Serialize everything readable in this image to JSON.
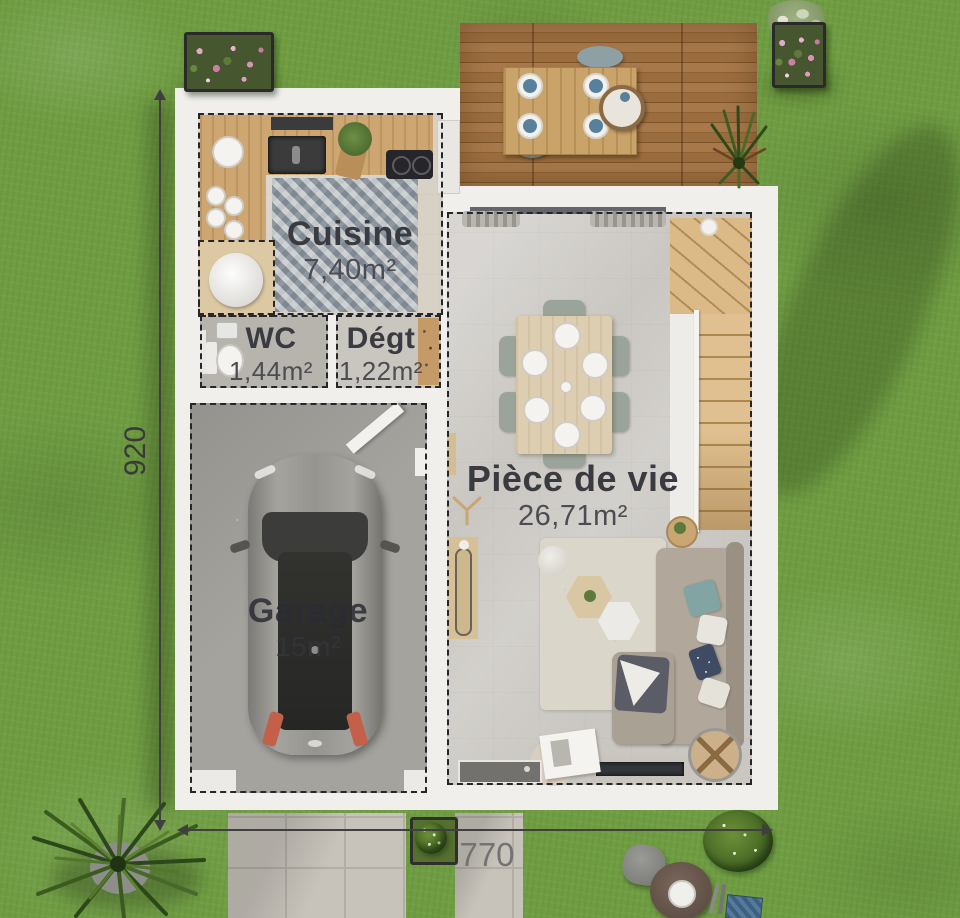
{
  "plan": {
    "title_note": "floor plan top view",
    "rooms": {
      "cuisine": {
        "name": "Cuisine",
        "area": "7,40m²"
      },
      "wc": {
        "name": "WC",
        "area": "1,44m²"
      },
      "degt": {
        "name": "Dégt",
        "area": "1,22m²"
      },
      "piece_de_vie": {
        "name": "Pièce de vie",
        "area": "26,71m²"
      },
      "garage": {
        "name": "Garage",
        "area": "15m²"
      }
    },
    "dimensions": {
      "height_label": "920",
      "width_label": "770"
    },
    "colors": {
      "grass": "#6f9d42",
      "deck_wood": "#9b6d3e",
      "wall_white": "#f0efec",
      "living_floor": "#cac7c2",
      "garage_floor": "#a5a39e",
      "label_text": "#3a3a41",
      "dimension_text": "#6f6f6f",
      "dashed_border": "#26262a"
    },
    "icons": {
      "palm_tree": "palm-tree-icon",
      "grass_tuft": "grass-tuft-icon",
      "flower_planter": "flower-planter-icon",
      "bush": "bush-icon",
      "ceiling_fan": "ceiling-fan-icon"
    }
  }
}
